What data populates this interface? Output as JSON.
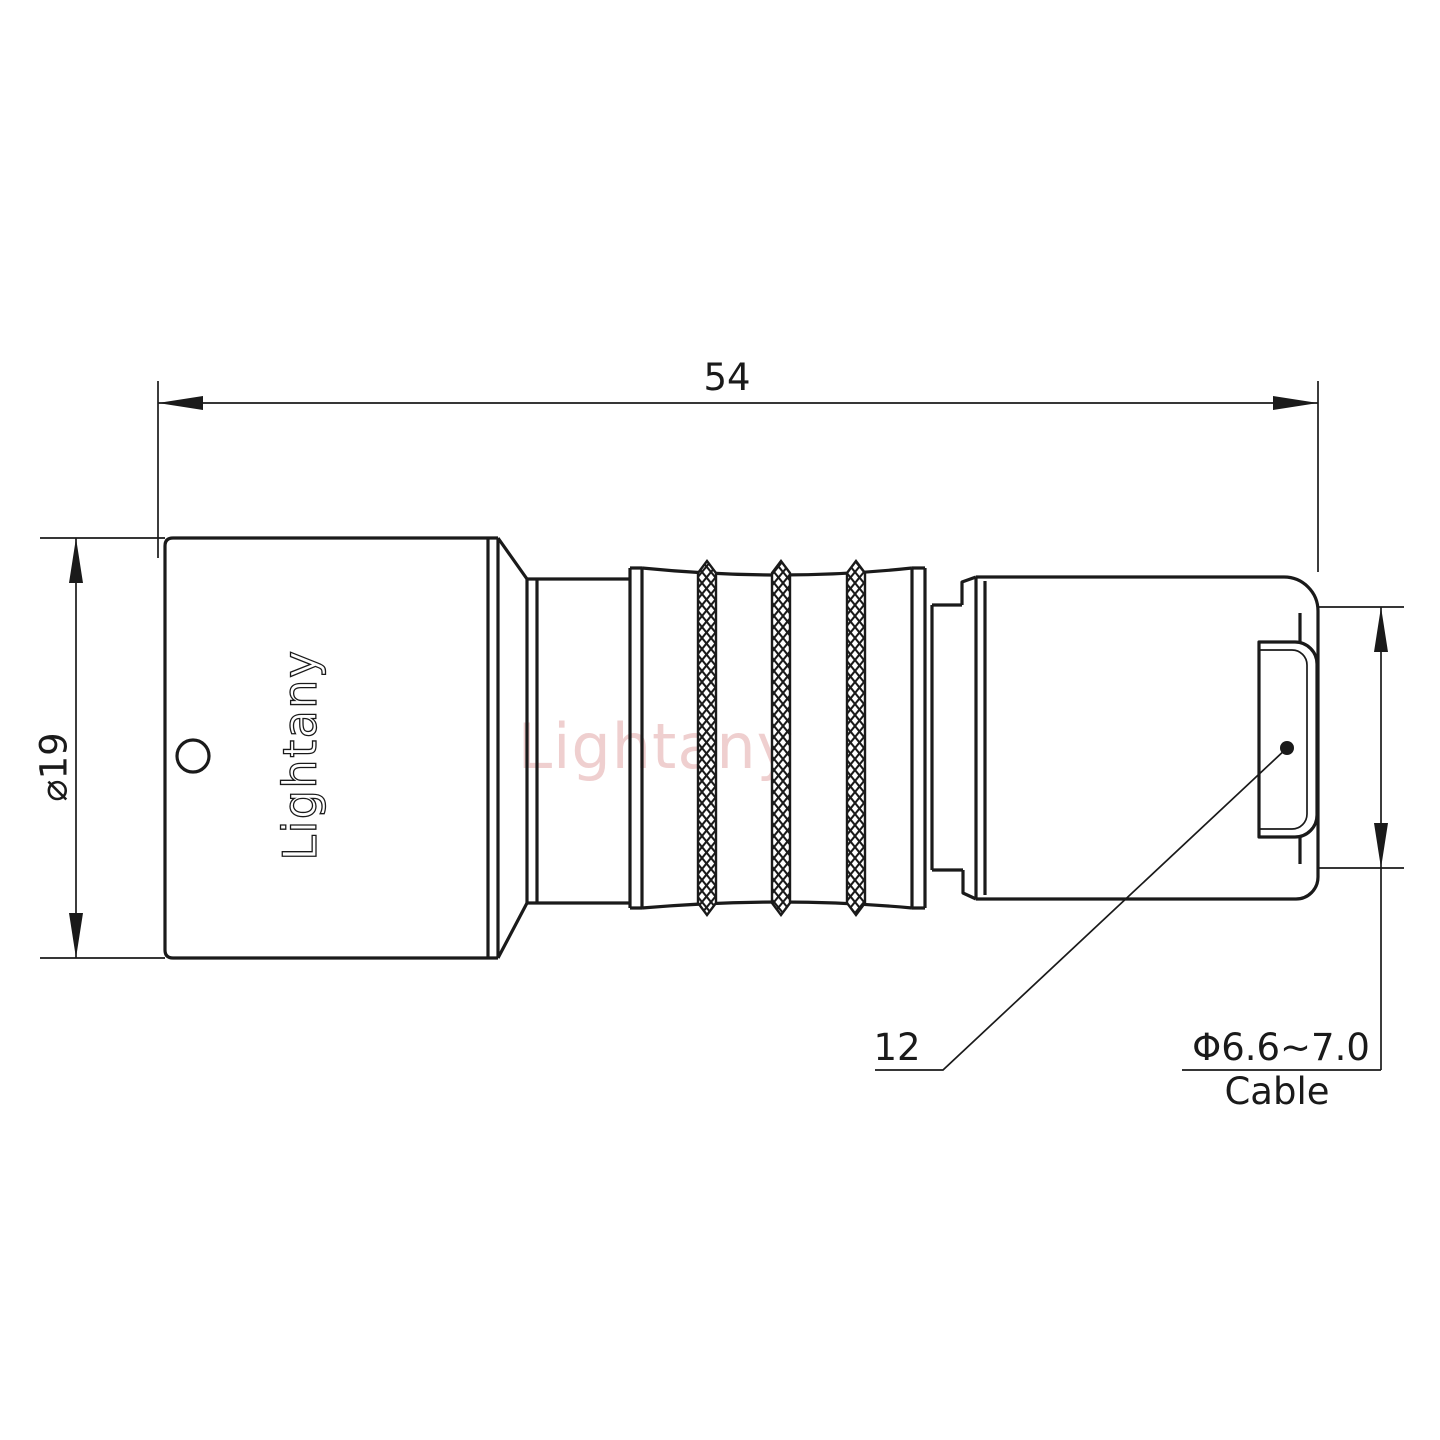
{
  "drawing": {
    "watermark": "Lightany",
    "brand_engraving": "Lightany",
    "dimensions": {
      "overall_length": "54",
      "front_diameter": "⌀19",
      "rear_size": "12",
      "cable_diameter": "Φ6.6~7.0",
      "cable_caption": "Cable"
    },
    "colors": {
      "line": "#1a1a1a",
      "watermark": "#d98c8c"
    }
  }
}
